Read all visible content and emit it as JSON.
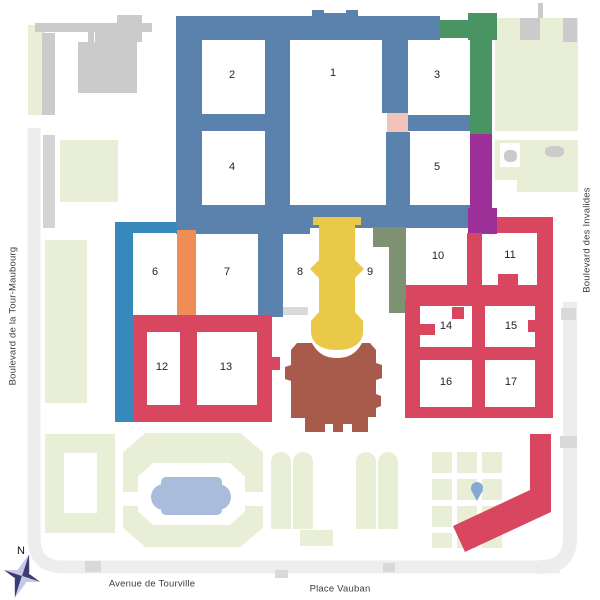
{
  "streets": {
    "left": "Boulevard de la Tour-Maubourg",
    "right": "Boulevard des Invalides",
    "bottom_left": "Avenue de Tourville",
    "bottom_right": "Place Vauban"
  },
  "compass": {
    "north_label": "N"
  },
  "courtyards": [
    "1",
    "2",
    "3",
    "4",
    "5",
    "6",
    "7",
    "8",
    "9",
    "10",
    "11",
    "12",
    "13",
    "14",
    "15",
    "16",
    "17"
  ],
  "colors": {
    "steel_blue": "#5b81ad",
    "light_blue": "#3789bc",
    "orange": "#ee8d55",
    "yellow": "#e9c947",
    "olive": "#7e9173",
    "green": "#4a9463",
    "purple": "#9c3098",
    "pink": "#f2c3ba",
    "red": "#d8475f",
    "brown": "#a85a4b",
    "garden_green": "#e9eed6",
    "building_grey": "#cbcbcb",
    "road_grey": "#ededed",
    "pond_blue": "#a9bcdc",
    "pin_blue": "#84a9d4",
    "compass_dark": "#3c3c74",
    "compass_light": "#c6c8e6",
    "label_text": "#232323",
    "street_text": "#3c3c3c"
  }
}
